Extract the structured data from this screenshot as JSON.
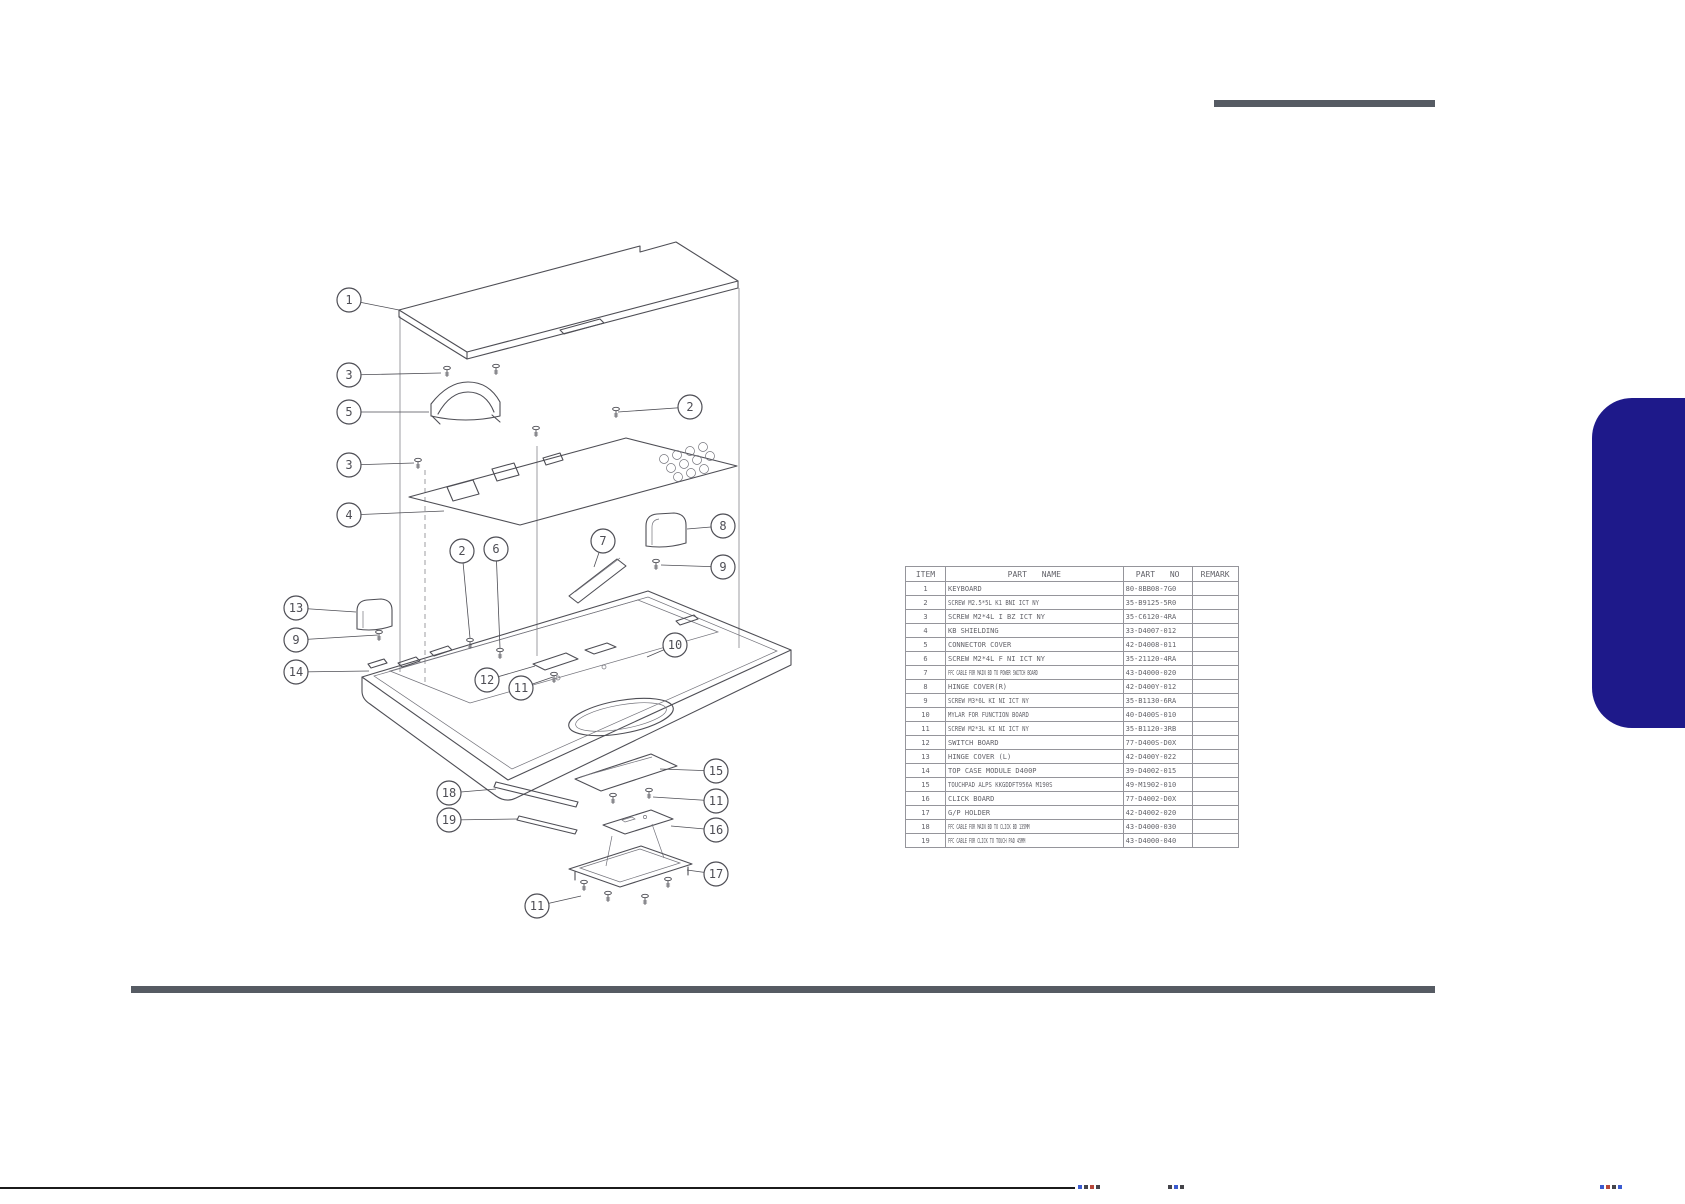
{
  "page": {
    "background": "#ffffff",
    "accent_navy": "#1e198a",
    "rule_gray": "#565b63",
    "drawing_line_color": "#4e4e55"
  },
  "parts_table": {
    "headers": [
      "ITEM",
      "PART NAME",
      "PART NO",
      "REMARK"
    ],
    "rows": [
      {
        "item": "1",
        "name": "KEYBOARD",
        "part_no": "80-8BB08-7G0",
        "remark": ""
      },
      {
        "item": "2",
        "name": "SCREW M2.5*5L K1 BNI ICT NY",
        "part_no": "35-B9125-5R0",
        "remark": ""
      },
      {
        "item": "3",
        "name": "SCREW M2*4L I BZ ICT NY",
        "part_no": "35-C6120-4RA",
        "remark": ""
      },
      {
        "item": "4",
        "name": "KB SHIELDING",
        "part_no": "33-D4007-012",
        "remark": ""
      },
      {
        "item": "5",
        "name": "CONNECTOR COVER",
        "part_no": "42-D4008-011",
        "remark": ""
      },
      {
        "item": "6",
        "name": "SCREW M2*4L F NI ICT NY",
        "part_no": "35-21120-4RA",
        "remark": ""
      },
      {
        "item": "7",
        "name": "FFC CABLE FOR MAIN BD TO POWER SWITCH BOARD",
        "part_no": "43-D4000-020",
        "remark": ""
      },
      {
        "item": "8",
        "name": "HINGE COVER(R)",
        "part_no": "42-D400Y-012",
        "remark": ""
      },
      {
        "item": "9",
        "name": "SCREW M3*6L KI NI ICT NY",
        "part_no": "35-B1130-6RA",
        "remark": ""
      },
      {
        "item": "10",
        "name": "MYLAR FOR FUNCTION BOARD",
        "part_no": "40-D400S-010",
        "remark": ""
      },
      {
        "item": "11",
        "name": "SCREW M2*3L KI NI ICT NY",
        "part_no": "35-B1120-3RB",
        "remark": ""
      },
      {
        "item": "12",
        "name": "SWITCH BOARD",
        "part_no": "77-D400S-D0X",
        "remark": ""
      },
      {
        "item": "13",
        "name": "HINGE COVER (L)",
        "part_no": "42-D400Y-022",
        "remark": ""
      },
      {
        "item": "14",
        "name": "TOP CASE MODULE D400P",
        "part_no": "39-D4002-015",
        "remark": ""
      },
      {
        "item": "15",
        "name": "TOUCHPAD ALPS KKGDDFT956A M190S",
        "part_no": "49-M1902-010",
        "remark": ""
      },
      {
        "item": "16",
        "name": "CLICK BOARD",
        "part_no": "77-D4002-D0X",
        "remark": ""
      },
      {
        "item": "17",
        "name": "G/P HOLDER",
        "part_no": "42-D4002-020",
        "remark": ""
      },
      {
        "item": "18",
        "name": "FFC CABLE FOR MAIN BD TO CLICK BD 135MM",
        "part_no": "43-D4000-030",
        "remark": ""
      },
      {
        "item": "19",
        "name": "FFC CABLE FOR CLICK TO TOUCH PAD 45MM",
        "part_no": "43-D4000-040",
        "remark": ""
      }
    ]
  },
  "diagram": {
    "description": "Exploded view of keyboard / top case assembly",
    "callouts": [
      {
        "n": "1",
        "cx": 349,
        "cy": 300,
        "tx": 399,
        "ty": 310
      },
      {
        "n": "3",
        "cx": 349,
        "cy": 375,
        "tx": 441,
        "ty": 373
      },
      {
        "n": "5",
        "cx": 349,
        "cy": 412,
        "tx": 429,
        "ty": 412
      },
      {
        "n": "3",
        "cx": 349,
        "cy": 465,
        "tx": 414,
        "ty": 463
      },
      {
        "n": "4",
        "cx": 349,
        "cy": 515,
        "tx": 444,
        "ty": 511
      },
      {
        "n": "2",
        "cx": 690,
        "cy": 407,
        "tx": 618,
        "ty": 412
      },
      {
        "n": "2",
        "cx": 462,
        "cy": 551,
        "tx": 470,
        "ty": 638
      },
      {
        "n": "6",
        "cx": 496,
        "cy": 549,
        "tx": 500,
        "ty": 648
      },
      {
        "n": "7",
        "cx": 603,
        "cy": 541,
        "tx": 594,
        "ty": 567
      },
      {
        "n": "8",
        "cx": 723,
        "cy": 526,
        "tx": 687,
        "ty": 529
      },
      {
        "n": "9",
        "cx": 723,
        "cy": 567,
        "tx": 661,
        "ty": 565
      },
      {
        "n": "13",
        "cx": 296,
        "cy": 608,
        "tx": 356,
        "ty": 612
      },
      {
        "n": "9",
        "cx": 296,
        "cy": 640,
        "tx": 378,
        "ty": 635
      },
      {
        "n": "14",
        "cx": 296,
        "cy": 672,
        "tx": 369,
        "ty": 671
      },
      {
        "n": "10",
        "cx": 675,
        "cy": 645,
        "tx": 647,
        "ty": 657
      },
      {
        "n": "12",
        "cx": 487,
        "cy": 680,
        "tx": 535,
        "ty": 666
      },
      {
        "n": "11",
        "cx": 521,
        "cy": 688,
        "tx": 553,
        "ty": 677
      },
      {
        "n": "15",
        "cx": 716,
        "cy": 771,
        "tx": 660,
        "ty": 769
      },
      {
        "n": "18",
        "cx": 449,
        "cy": 793,
        "tx": 496,
        "ty": 789
      },
      {
        "n": "11",
        "cx": 716,
        "cy": 801,
        "tx": 653,
        "ty": 797
      },
      {
        "n": "19",
        "cx": 449,
        "cy": 820,
        "tx": 517,
        "ty": 819
      },
      {
        "n": "16",
        "cx": 716,
        "cy": 830,
        "tx": 671,
        "ty": 826
      },
      {
        "n": "17",
        "cx": 716,
        "cy": 874,
        "tx": 687,
        "ty": 870
      },
      {
        "n": "11",
        "cx": 537,
        "cy": 906,
        "tx": 581,
        "ty": 896
      }
    ]
  }
}
